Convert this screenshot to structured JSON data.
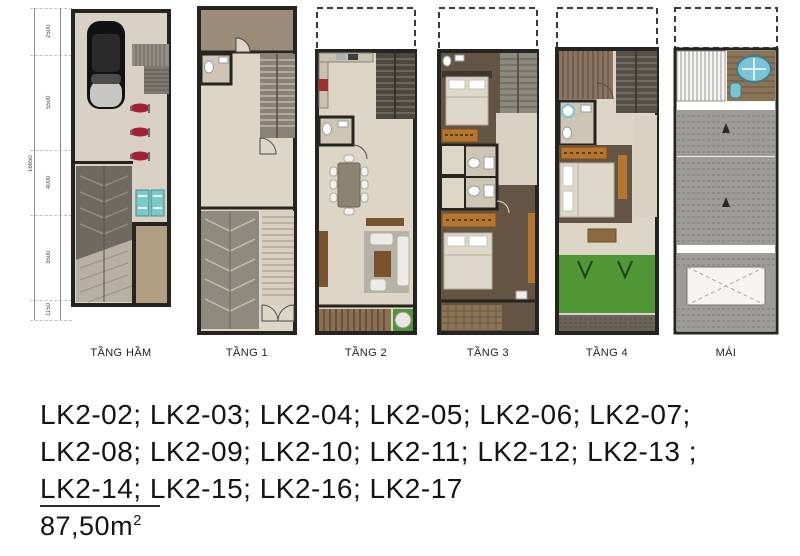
{
  "document": {
    "type": "townhouse-floor-plan-sheet",
    "background": "#ffffff"
  },
  "floors": [
    {
      "id": "tang-ham",
      "label": "TẦNG HẦM"
    },
    {
      "id": "tang-1",
      "label": "TẦNG 1"
    },
    {
      "id": "tang-2",
      "label": "TẦNG 2"
    },
    {
      "id": "tang-3",
      "label": "TẦNG 3"
    },
    {
      "id": "tang-4",
      "label": "TẦNG 4"
    },
    {
      "id": "mai",
      "label": "MÁI"
    }
  ],
  "dimensions": {
    "segments": [
      "2500",
      "5500",
      "4000",
      "3500",
      "1150"
    ],
    "total": "16650"
  },
  "lots": {
    "lines": [
      "LK2-02; LK2-03; LK2-04; LK2-05; LK2-06; LK2-07;",
      "LK2-08; LK2-09; LK2-10; LK2-11; LK2-12; LK2-13 ;",
      "LK2-14; LK2-15; LK2-16; LK2-17"
    ],
    "codes": [
      "LK2-02",
      "LK2-03",
      "LK2-04",
      "LK2-05",
      "LK2-06",
      "LK2-07",
      "LK2-08",
      "LK2-09",
      "LK2-10",
      "LK2-11",
      "LK2-12",
      "LK2-13",
      "LK2-14",
      "LK2-15",
      "LK2-16",
      "LK2-17"
    ]
  },
  "area": {
    "value": "87,50m²",
    "value_base": "87,50m",
    "value_sup": "2"
  },
  "colors": {
    "wall": "#26241f",
    "floor_beige": "#d9d1c3",
    "terrace_brown": "#9b8b79",
    "wood_deck": "#8b6f52",
    "dark_wood_floor": "#5f5143",
    "grass_green": "#4f9735",
    "water_tank_cyan": "#7ac4d4",
    "roof_tile_gray": "#9e9c98",
    "motorbike_red": "#a22434",
    "cabinet_brown": "#7a5230",
    "wardrobe_orange": "#b5762f"
  }
}
